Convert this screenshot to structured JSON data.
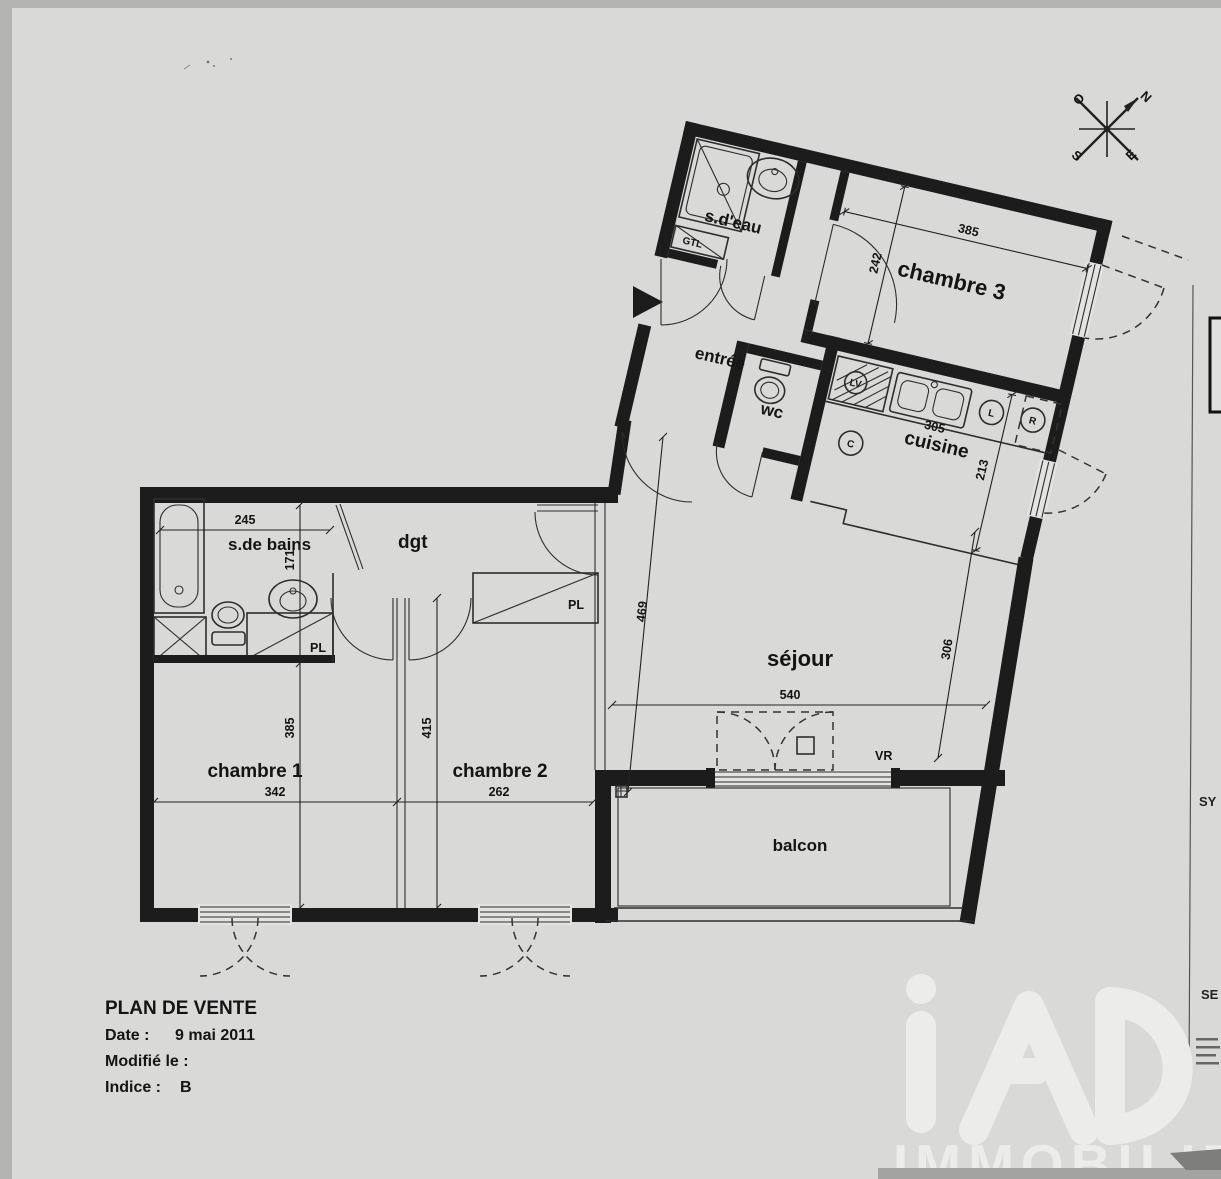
{
  "rooms": {
    "sdeau": "s.d'eau",
    "gtl": "GTL",
    "chambre3": "chambre 3",
    "entree": "entrée",
    "wc": "wc",
    "cuisine": "cuisine",
    "sdebains": "s.de bains",
    "dgt": "dgt",
    "pl_sdb": "PL",
    "pl_dgt": "PL",
    "sejour": "séjour",
    "chambre1": "chambre 1",
    "chambre2": "chambre 2",
    "balcon": "balcon",
    "vr": "VR"
  },
  "appliances": {
    "lv": "LV",
    "l": "L",
    "r": "R",
    "c": "C"
  },
  "dims": {
    "ch3_width": "385",
    "ch3_depth": "242",
    "cuisine_width": "305",
    "cuisine_depth": "213",
    "sdb_width": "245",
    "sdb_depth": "171",
    "sejour_length": "469",
    "sejour_width": "540",
    "sejour_side": "306",
    "ch1_width": "342",
    "ch1_height": "385",
    "ch2_width": "262",
    "ch2_height": "415"
  },
  "compass": {
    "n": "N",
    "e": "E",
    "s": "S",
    "o": "O"
  },
  "title_block": {
    "title": "PLAN DE VENTE",
    "date_label": "Date :",
    "date_value": "9 mai 2011",
    "modified_label": "Modifié le :",
    "indice_label": "Indice :",
    "indice_value": "B"
  },
  "side_panel": {
    "label_top": "SY",
    "label_bottom": "SE"
  },
  "logo": {
    "brand": "iAD",
    "word": "IMMOBILIER"
  }
}
